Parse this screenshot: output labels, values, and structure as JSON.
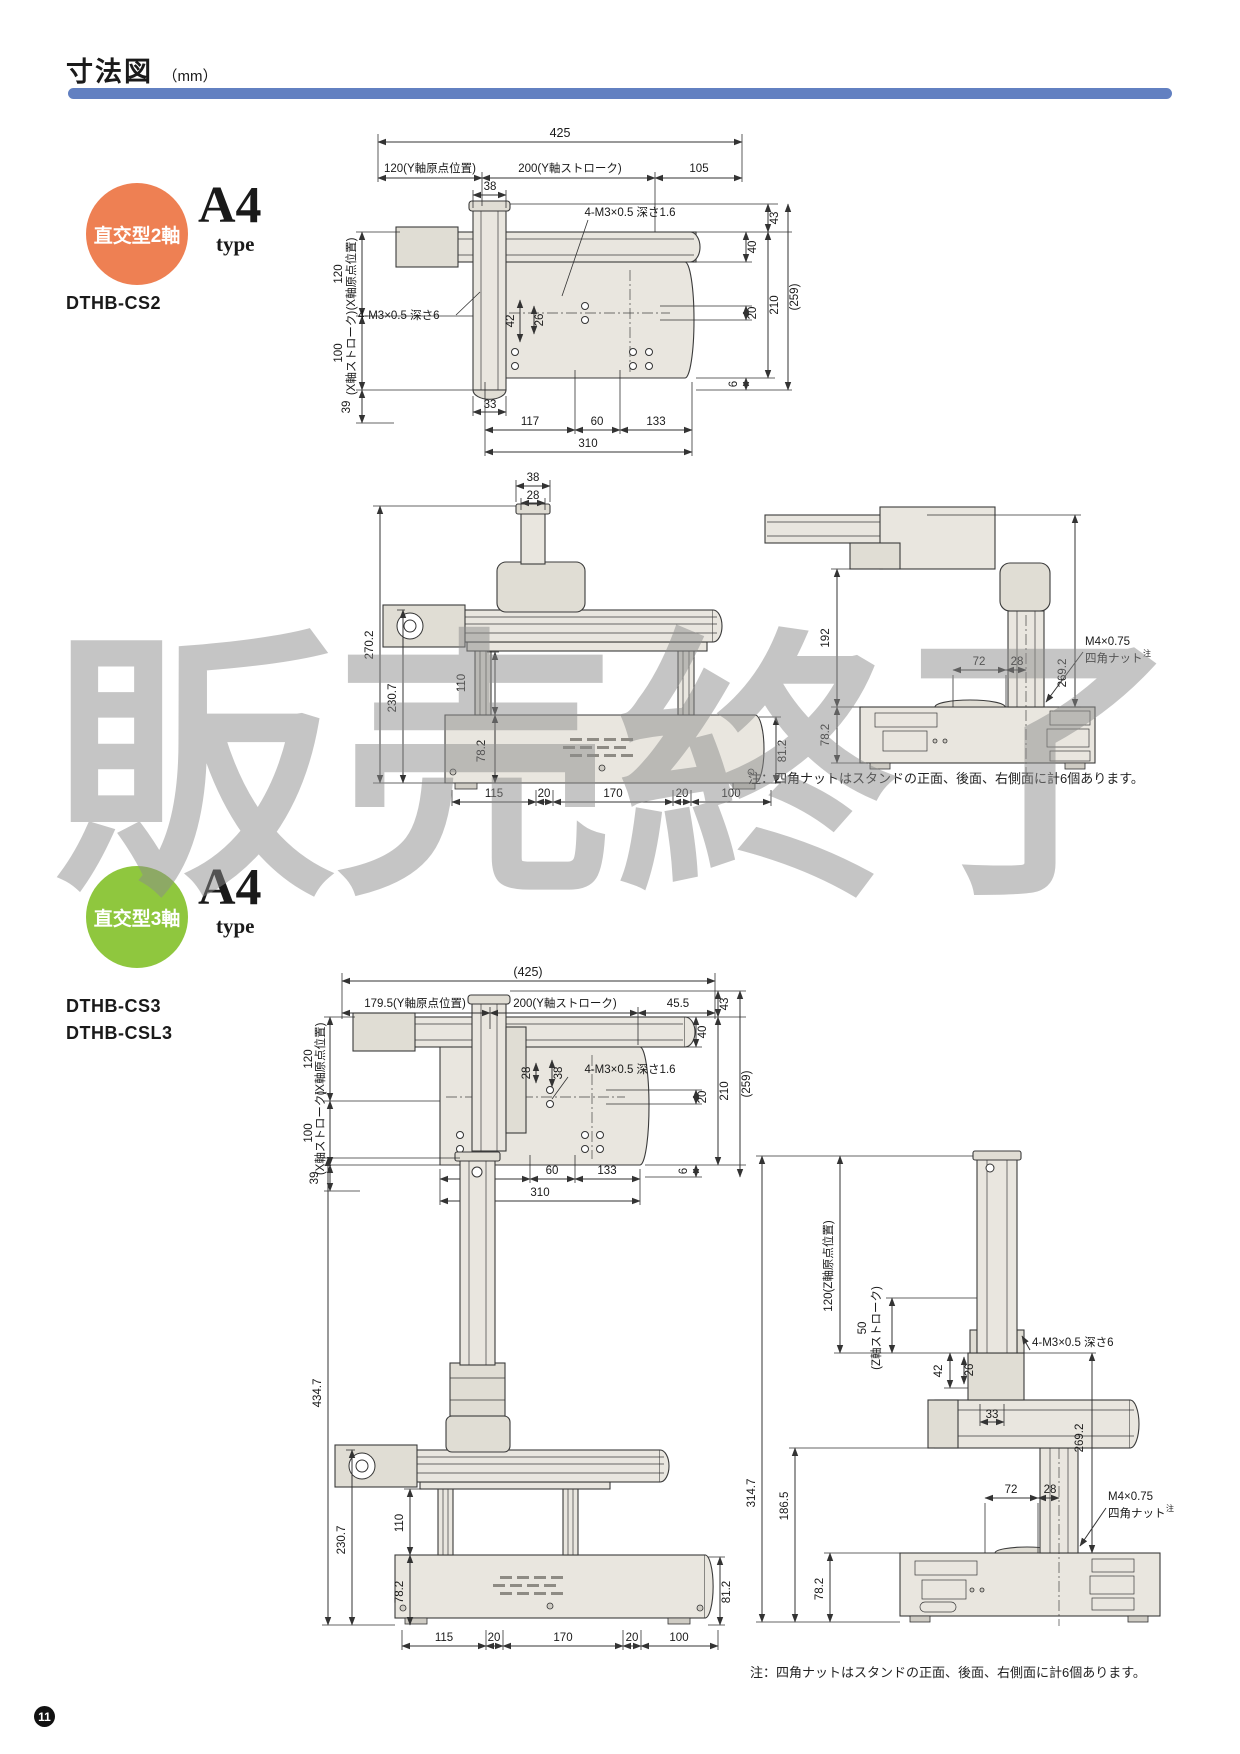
{
  "page": {
    "title": "寸法図",
    "unit": "（mm）",
    "page_number": "11",
    "watermark": "販売終了",
    "note": "注：四角ナットはスタンドの正面、後面、右側面に計6個あります。"
  },
  "sections": {
    "two_axis": {
      "badge": "直交型2軸",
      "paper": "A4",
      "paper_sub": "type",
      "models": [
        "DTHB-CS2"
      ]
    },
    "three_axis": {
      "badge": "直交型3軸",
      "paper": "A4",
      "paper_sub": "type",
      "models": [
        "DTHB-CS3",
        "DTHB-CSL3"
      ]
    }
  },
  "colors": {
    "accent_bar": "#6280c1",
    "badge_2axis": "#ee8053",
    "badge_3axis": "#8fc73e"
  },
  "d1": {
    "total": "425",
    "y_origin": "120(Y軸原点位置)",
    "y_stroke": "200(Y軸ストローク)",
    "end": "105",
    "col_w": "38",
    "x_origin": "120",
    "x_origin_sub": "(X軸原点位置)",
    "x_stroke": "100",
    "x_stroke_sub": "(X軸ストローク)",
    "edge": "39",
    "v42": "42",
    "v26": "26",
    "tap_top": "4-M3×0.5 深さ1.6",
    "tap_left": "4-M3×0.5 深さ6",
    "r43": "43",
    "r40": "40",
    "r20": "20",
    "r210": "210",
    "r259": "(259)",
    "r6": "6",
    "b33": "33",
    "b117": "117",
    "b60": "60",
    "b133": "133",
    "b310": "310"
  },
  "d2": {
    "t38": "38",
    "t28": "28",
    "h270": "270.2",
    "h230": "230.7",
    "h110": "110",
    "h78": "78.2",
    "h81": "81.2",
    "b115": "115",
    "b20a": "20",
    "b170": "170",
    "b20b": "20",
    "b100": "100"
  },
  "d3": {
    "h192": "192",
    "w72": "72",
    "w28": "28",
    "h269": "269.2",
    "h78": "78.2",
    "nut1": "M4×0.75",
    "nut2": "四角ナット",
    "nut_ref": "注"
  },
  "d4": {
    "total": "(425)",
    "y_origin": "179.5(Y軸原点位置)",
    "y_stroke": "200(Y軸ストローク)",
    "end": "45.5",
    "tap_top": "4-M3×0.5 深さ1.6",
    "w28": "28",
    "w38": "38",
    "x_origin": "120",
    "x_origin_sub": "(X軸原点位置)",
    "x_stroke": "100",
    "x_stroke_sub": "(X軸ストローク)",
    "edge": "39",
    "r43": "43",
    "r40": "40",
    "r20": "20",
    "r210": "210",
    "r259": "(259)",
    "r6": "6",
    "b117": "117",
    "b60": "60",
    "b133": "133",
    "b310": "310"
  },
  "d5": {
    "h434": "434.7",
    "h230": "230.7",
    "h110": "110",
    "h78": "78.2",
    "h81": "81.2",
    "b115": "115",
    "b20a": "20",
    "b170": "170",
    "b20b": "20",
    "b100": "100"
  },
  "d6": {
    "z_origin": "120(Z軸原点位置)",
    "z_stroke": "50",
    "z_stroke_sub": "(Z軸ストローク)",
    "tap": "4-M3×0.5 深さ6",
    "v42": "42",
    "v26": "26",
    "b33": "33",
    "w72": "72",
    "w28": "28",
    "h314": "314.7",
    "h186": "186.5",
    "h269": "269.2",
    "h78": "78.2",
    "nut1": "M4×0.75",
    "nut2": "四角ナット",
    "nut_ref": "注"
  }
}
